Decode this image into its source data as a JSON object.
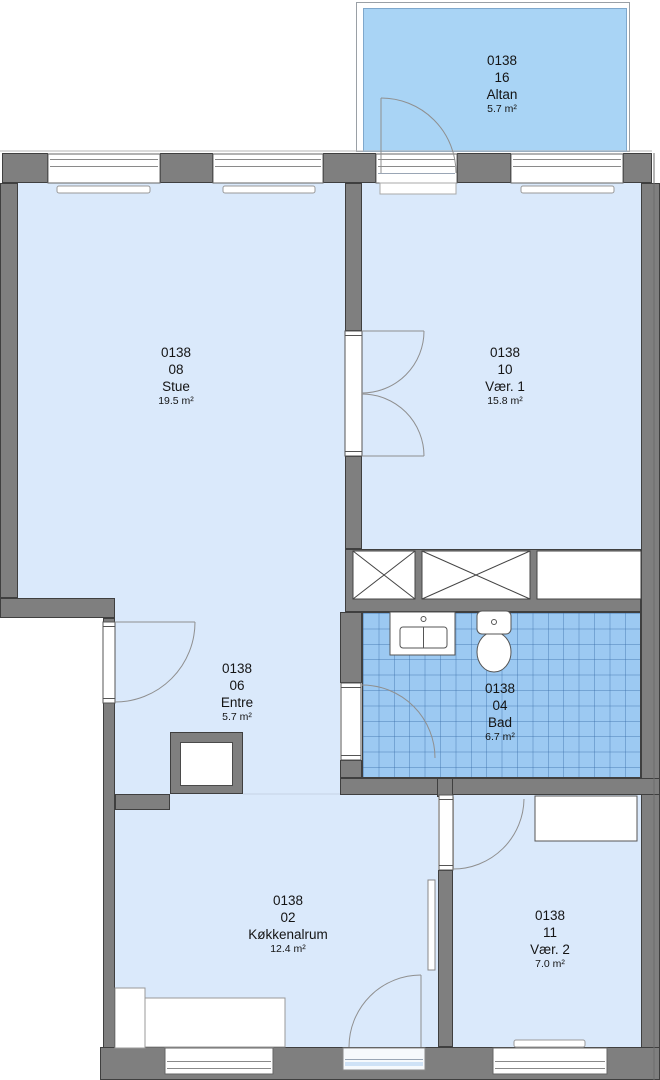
{
  "drawing_title": "Floor plan – apartment 0138",
  "colors": {
    "wall": "#7f7f7f",
    "wall_outline": "#3f3f3f",
    "floor": "#dae9fb",
    "wet_room_tile": "#9cc9f2",
    "balcony": "#a9d4f5",
    "label_text": "#141414"
  },
  "rooms": {
    "altan": {
      "code": "0138",
      "number": "16",
      "name": "Altan",
      "area": "5.7 m²"
    },
    "stue": {
      "code": "0138",
      "number": "08",
      "name": "Stue",
      "area": "19.5 m²"
    },
    "vaer1": {
      "code": "0138",
      "number": "10",
      "name": "Vær. 1",
      "area": "15.8 m²"
    },
    "entre": {
      "code": "0138",
      "number": "06",
      "name": "Entre",
      "area": "5.7 m²"
    },
    "bad": {
      "code": "0138",
      "number": "04",
      "name": "Bad",
      "area": "6.7 m²"
    },
    "koekkenalrum": {
      "code": "0138",
      "number": "02",
      "name": "Køkkenalrum",
      "area": "12.4 m²"
    },
    "vaer2": {
      "code": "0138",
      "number": "11",
      "name": "Vær. 2",
      "area": "7.0 m²"
    }
  }
}
